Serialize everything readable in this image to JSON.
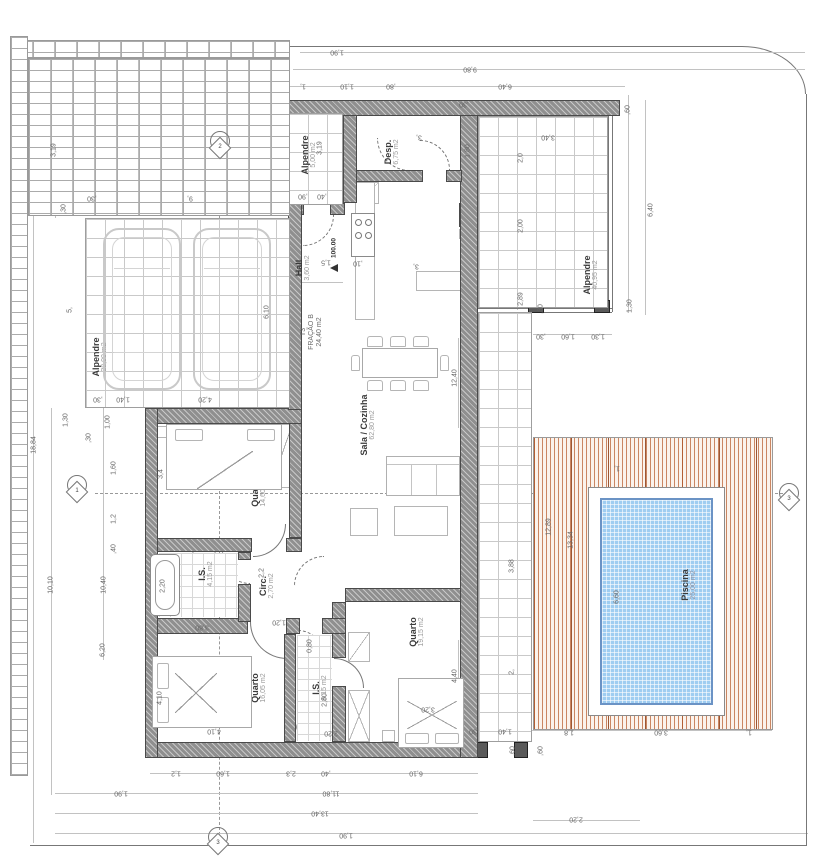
{
  "rooms": {
    "garage": {
      "name": "Alpendre",
      "area": "38,00 m2"
    },
    "entry_porch": {
      "name": "Alpendre",
      "area": "5,00 m2"
    },
    "hall": {
      "name": "Hall",
      "area": "3,60 m2"
    },
    "pantry": {
      "name": "Desp.",
      "area": "6,75 m2"
    },
    "living": {
      "name": "Sala / Cozinha",
      "area": "62,80 m2"
    },
    "bedroom1": {
      "name": "Quarto",
      "area": "14,60 m2"
    },
    "bath1": {
      "name": "I.S.",
      "area": "4,15 m2"
    },
    "circ": {
      "name": "Circ.",
      "area": "2,70 m2"
    },
    "bedroom2": {
      "name": "Quarto",
      "area": "16,05 m2"
    },
    "bath2": {
      "name": "I.S.",
      "area": "6,15 m2"
    },
    "bedroom3": {
      "name": "Quarto",
      "area": "19,15 m2"
    },
    "porch_ne": {
      "name": "Alpendre",
      "area": "40,95 m2"
    },
    "pool": {
      "name": "Piscina",
      "area": "25,00 m2"
    }
  },
  "unit": {
    "line1": "T3",
    "line2": "FRAÇÃO B",
    "line3": "24,40 m2"
  },
  "levels": {
    "hall": "100.00"
  },
  "markers": {
    "top": "2",
    "left": "1",
    "bottom": "3",
    "right": "3"
  },
  "dims": {
    "top_190": "1,90",
    "top_980": "9,80",
    "top_1": "1,",
    "top_110": "1,10",
    "top_80": ",80",
    "top_640": "6,40",
    "ne_60": ",60",
    "ne_640": "6,40",
    "ne_130": "1,30",
    "ne_340": "3,40",
    "ne_20": "2,0",
    "ne_200": "2,00",
    "ne_289": "2,89",
    "ne_30": ",30",
    "nec_30": ",30",
    "nec_160": "1,60",
    "nec_130": "1,30",
    "e_1240": "12,40",
    "e_388": "3,88",
    "e_2": "2,",
    "e_440": "4,40",
    "e_180": "1,80",
    "e_30": ",30",
    "desp_3": "3,",
    "p5_319": "3,19",
    "p5_90": ",90",
    "p5_40": ",40",
    "hall_15": "1,5",
    "hall_10": ",10",
    "isl_3": "3,",
    "gar_610": "6,10",
    "gar_420": "4,20",
    "gar_30": ",30",
    "gar_140": "1,40",
    "gar_9": "9,",
    "gar_30t": ",30",
    "tl_319": "3,19",
    "tl_30": ",30",
    "tl_5": "5,",
    "l_130": "1,30",
    "l_100": "1,00",
    "l_30": ",30",
    "l_160": "1,60",
    "l_12": "1,2",
    "l_40": ",40",
    "l_1884": "18,84",
    "l_1010": "10,10",
    "l_1040": "10,40",
    "l_620": "6,20",
    "q1_34": "3,4",
    "is1_220": "2,20",
    "circ_22": "2,2",
    "q2_410l": "4,10",
    "q2_410b": "4,10",
    "d_380": "3,80",
    "d_120": "1,20",
    "d_080": "0,80",
    "is2_280": "2,80",
    "is2_220": "2,20",
    "q3_320": "3,20",
    "b_12": "1,2",
    "b_160": "1,60",
    "b_23": "2,3",
    "b_40": ",40",
    "b_610": "6,10",
    "b_190": "1,90",
    "b_1180": "11,80",
    "b_1340": "13,40",
    "b_190b": "1,90",
    "dk_30": ",30",
    "dk_140": "1,40",
    "dk_18": "1,8",
    "dk_360": "3,60",
    "dk_1": "1,",
    "dk_220": "2,20",
    "dk_60a": ",60",
    "dk_60b": ",60",
    "dk_1289": "12,89",
    "dk_1334": "13,34",
    "pool_660": "6,60",
    "dk_1t": "1,"
  },
  "colors": {
    "wall": "#8f8f8f",
    "wall_dark": "#555555",
    "deck_stripe": "#b5714b",
    "pool_water": "#9fcdf1",
    "tile_line": "#c9c9c9",
    "dim_text": "#666666"
  }
}
